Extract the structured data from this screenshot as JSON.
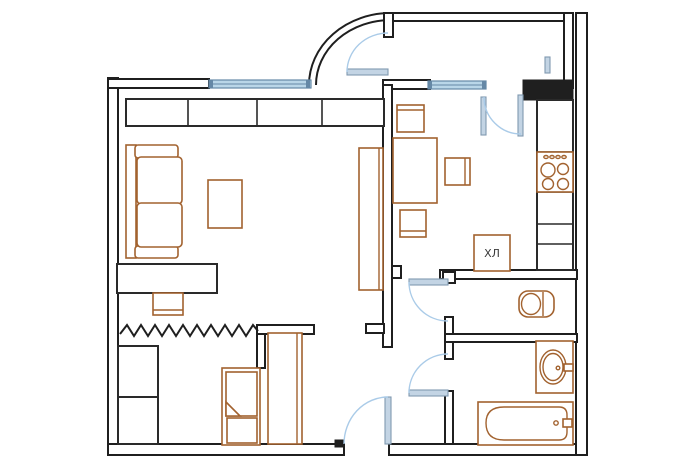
{
  "plan": {
    "labels": {
      "fridge": "ХЛ"
    },
    "colors": {
      "background": "#ffffff",
      "wall": "#1f1f1f",
      "furniture_black": "#2a2a2a",
      "furniture": "#a2622f",
      "window_fill": "#b9d6e8",
      "window_stroke": "#6588a6",
      "door_leaf_fill": "#c3d4e4",
      "door_leaf_stroke": "#8099b0",
      "swing_arc": "#aacbe8",
      "text": "#3a3a3a"
    }
  }
}
